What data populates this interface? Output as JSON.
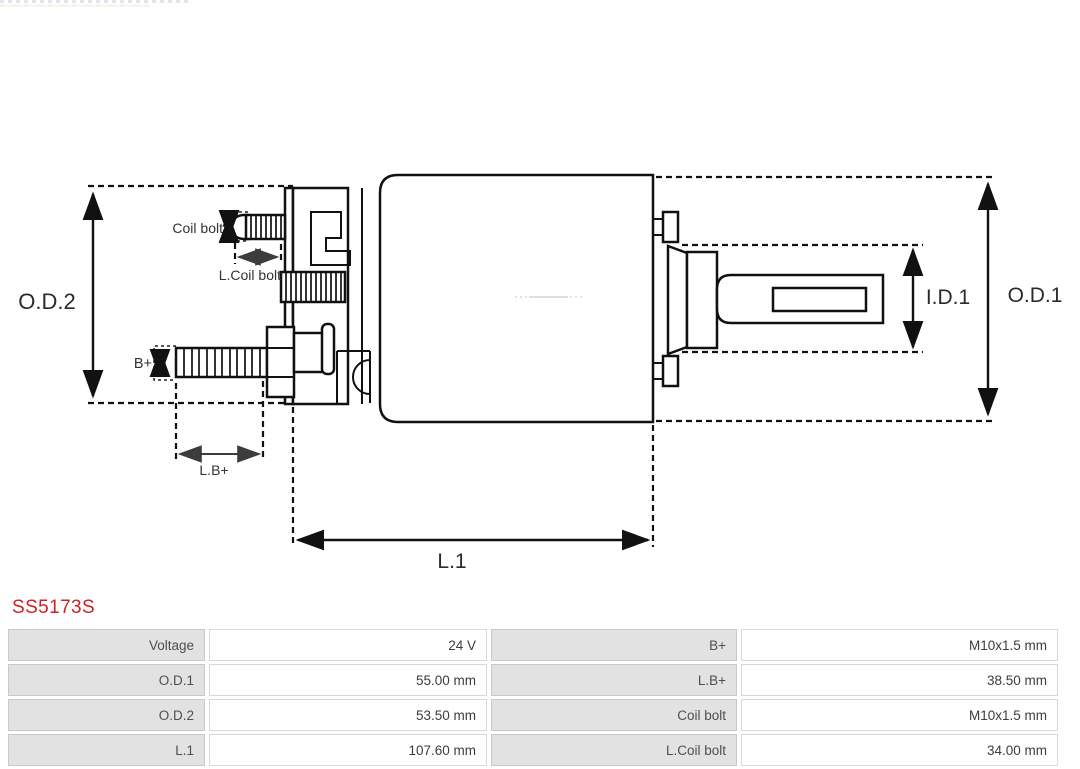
{
  "page": {
    "background": "#ffffff"
  },
  "part_number": {
    "text": "SS5173S",
    "color": "#cc2127"
  },
  "diagram": {
    "type": "starter-solenoid-technical-drawing",
    "line_color": "#111111",
    "dimension_labels": {
      "od2": "O.D.2",
      "od1": "O.D.1",
      "id1": "I.D.1",
      "l1": "L.1",
      "coil_bolt": "Coil bolt",
      "l_coil_bolt": "L.Coil bolt",
      "b_plus": "B+",
      "l_b_plus": "L.B+"
    }
  },
  "spec_table": {
    "label_bg": "#e2e2e2",
    "rows": [
      [
        "Voltage",
        "24 V",
        "B+",
        "M10x1.5 mm"
      ],
      [
        "O.D.1",
        "55.00 mm",
        "L.B+",
        "38.50 mm"
      ],
      [
        "O.D.2",
        "53.50 mm",
        "Coil bolt",
        "M10x1.5 mm"
      ],
      [
        "L.1",
        "107.60 mm",
        "L.Coil bolt",
        "34.00 mm"
      ]
    ]
  }
}
